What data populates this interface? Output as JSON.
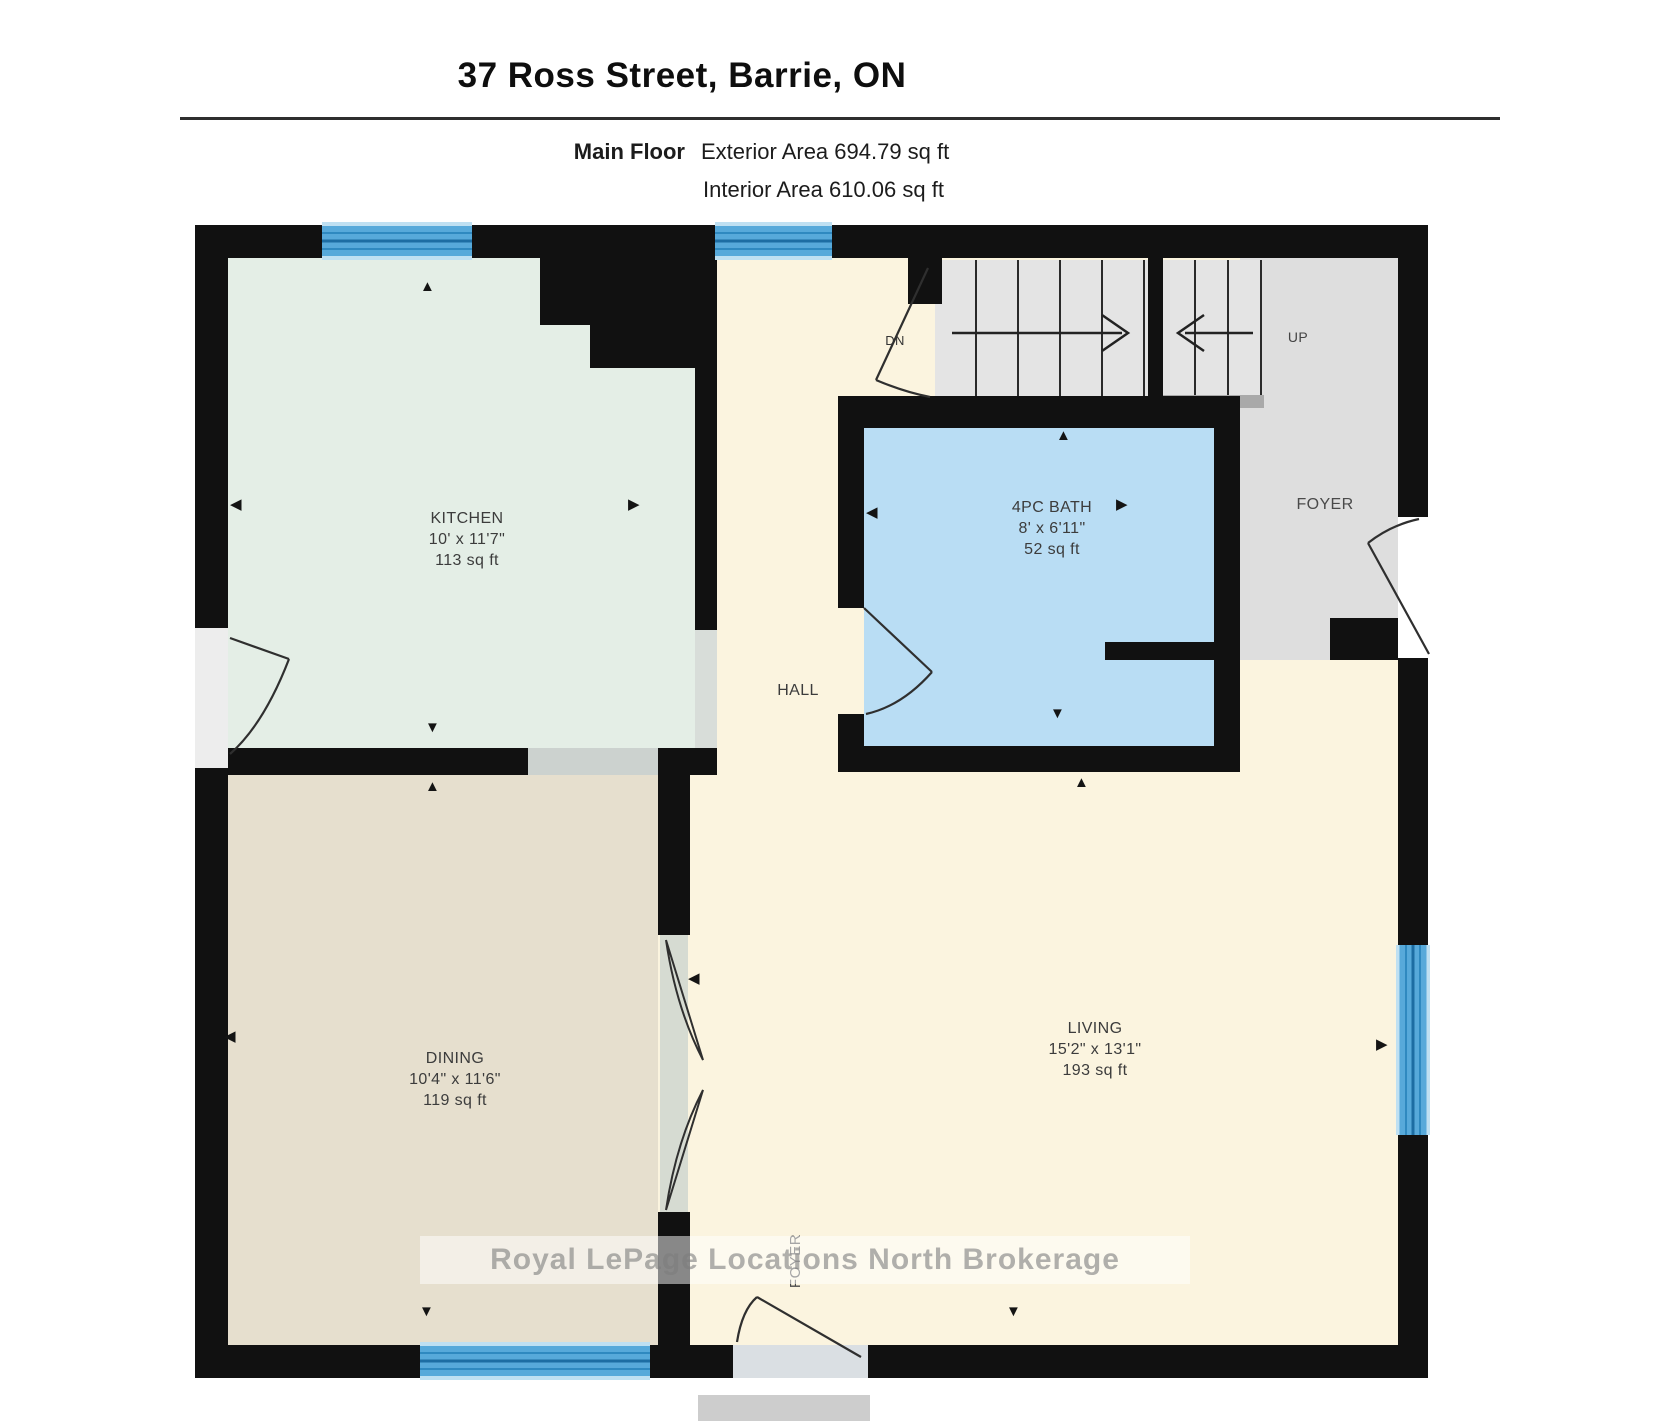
{
  "header": {
    "title": "37 Ross Street, Barrie, ON",
    "floor_label": "Main Floor",
    "exterior_area": "Exterior Area 694.79 sq ft",
    "interior_area": "Interior Area 610.06 sq ft"
  },
  "rooms": {
    "kitchen": {
      "name": "KITCHEN",
      "dims": "10' x 11'7\"",
      "area": "113 sq ft"
    },
    "dining": {
      "name": "DINING",
      "dims": "10'4\" x 11'6\"",
      "area": "119 sq ft"
    },
    "living": {
      "name": "LIVING",
      "dims": "15'2\" x 13'1\"",
      "area": "193 sq ft"
    },
    "bath": {
      "name": "4PC BATH",
      "dims": "8' x 6'11\"",
      "area": "52 sq ft"
    },
    "hall": {
      "name": "HALL"
    },
    "foyer_main": {
      "name": "FOYER"
    },
    "foyer_entry": {
      "name": "FOYER"
    }
  },
  "stairs": {
    "down_label": "DN",
    "up_label": "UP"
  },
  "icons": {
    "arrow_up": "▲",
    "arrow_down": "▼",
    "arrow_left": "◀",
    "arrow_right": "▶"
  },
  "watermark": "Royal LePage Locations North Brokerage",
  "colors": {
    "wall": "#111111",
    "kitchen": "#e4eee6",
    "dining": "#e6dfce",
    "living_hall": "#fbf4df",
    "bath": "#b9ddf4",
    "foyer": "#dedede",
    "window_blue": "#57a9da"
  }
}
